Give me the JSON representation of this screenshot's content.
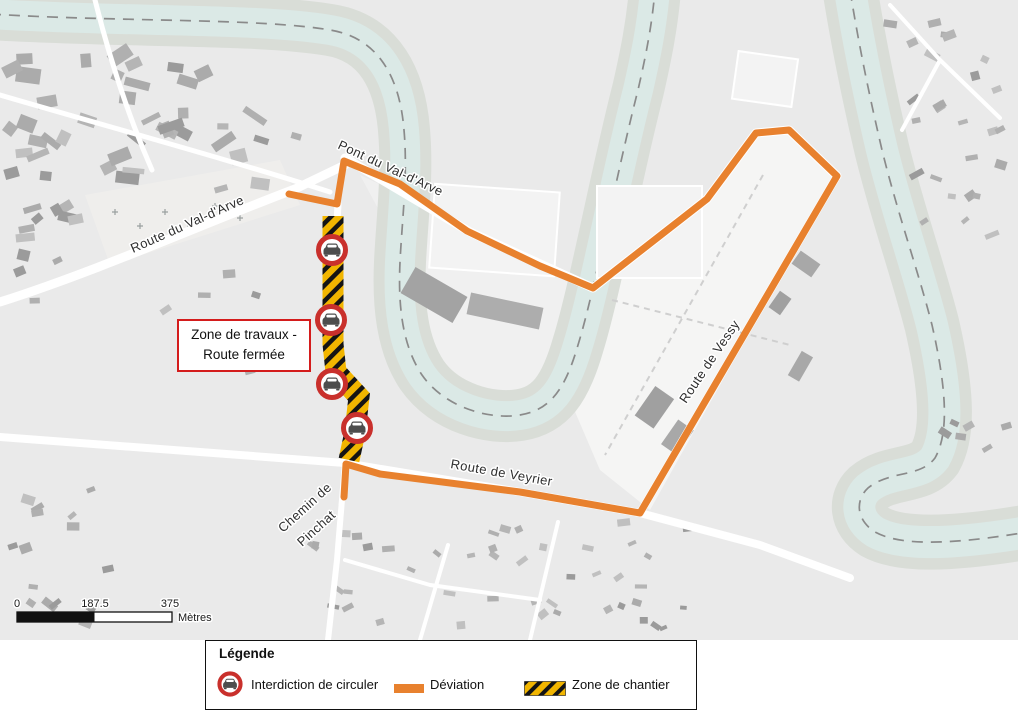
{
  "map": {
    "road_labels": [
      {
        "id": "pont-du-val-darve",
        "text": "Pont du Val-d'Arve"
      },
      {
        "id": "route-du-val-darve",
        "text": "Route du Val-d'Arve"
      },
      {
        "id": "route-de-vessy",
        "text": "Route de Vessy"
      },
      {
        "id": "route-de-veyrier",
        "text": "Route de Veyrier"
      },
      {
        "id": "chemin-de-pinchat-line1",
        "text": "Chemin de"
      },
      {
        "id": "chemin-de-pinchat-line2",
        "text": "Pinchat"
      }
    ],
    "callout": {
      "line1": "Zone de travaux  -",
      "line2": "Route fermée"
    },
    "no_entry_sign_count": 4
  },
  "scale_bar": {
    "ticks": [
      "0",
      "187.5",
      "375"
    ],
    "unit": "Mètres"
  },
  "legend": {
    "title": "Légende",
    "items": [
      {
        "icon": "no-entry-sign-icon",
        "label": "Interdiction de circuler"
      },
      {
        "icon": "deviation-line-icon",
        "label": "Déviation"
      },
      {
        "icon": "construction-hatch-icon",
        "label": "Zone de chantier"
      }
    ]
  },
  "colors": {
    "deviation_orange": "#e8812e",
    "chantier_yellow": "#f1b500",
    "chantier_black": "#141414",
    "sign_red": "#c9302c",
    "callout_border_red": "#d41c1c",
    "water": "#dbe9e6",
    "map_background": "#eaeaea"
  }
}
